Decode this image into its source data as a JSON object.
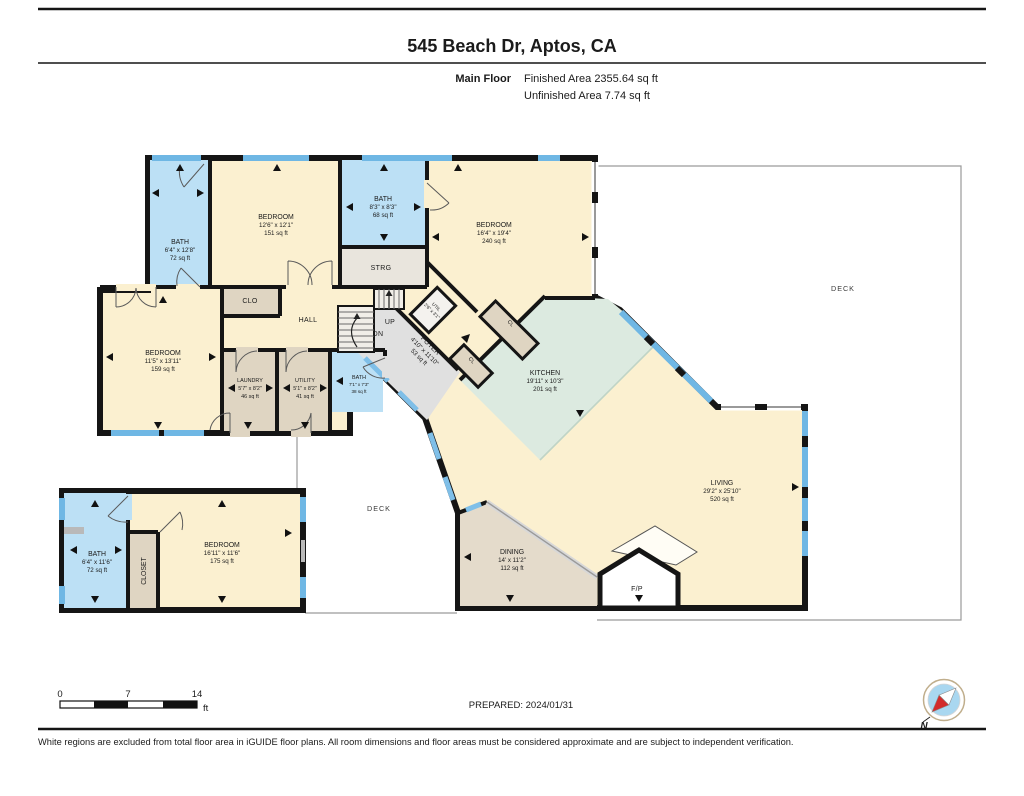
{
  "page": {
    "title": "545 Beach Dr, Aptos, CA",
    "floor_label": "Main Floor",
    "finished": "Finished Area 2355.64 sq ft",
    "unfinished": "Unfinished Area 7.74 sq ft",
    "prepared": "PREPARED: 2024/01/31",
    "disclaimer": "White regions are excluded from total floor area in iGUIDE floor plans. All room dimensions and floor areas must be considered approximate and are subject to independent verification."
  },
  "scale": {
    "t0": "0",
    "t1": "7",
    "t2": "14",
    "unit": "ft"
  },
  "compass": {
    "north": "N"
  },
  "colors": {
    "room_cream": "#FBF0D0",
    "room_blue": "#BCE0F5",
    "room_tan": "#DFD5C2",
    "room_gray": "#E0E0E0",
    "kitchen_teal": "#DCEAE0",
    "dining_tan": "#E4DBCB",
    "window_blue": "#6FB7E4",
    "wall_black": "#151515"
  },
  "rooms": {
    "bath_tl": {
      "name": "BATH",
      "dims": "6'4\" x 12'8\"",
      "area": "72 sq ft"
    },
    "bedroom_tl": {
      "name": "BEDROOM",
      "dims": "12'6\" x 12'1\"",
      "area": "151 sq ft"
    },
    "bath_top": {
      "name": "BATH",
      "dims": "8'3\" x 8'3\"",
      "area": "68 sq ft"
    },
    "strg": {
      "name": "STRG"
    },
    "clo": {
      "name": "CLO"
    },
    "hall": {
      "name": "HALL"
    },
    "bedroom_top": {
      "name": "BEDROOM",
      "dims": "16'4\" x 19'4\"",
      "area": "240 sq ft"
    },
    "bedroom_left": {
      "name": "BEDROOM",
      "dims": "11'5\" x 13'11\"",
      "area": "159 sq ft"
    },
    "laundry": {
      "name": "LAUNDRY",
      "dims": "5'7\" x 8'2\"",
      "area": "46 sq ft"
    },
    "utility": {
      "name": "UTILITY",
      "dims": "5'1\" x 8'2\"",
      "area": "41 sq ft"
    },
    "bath_mid": {
      "name": "BATH",
      "dims": "7'1\" x 7'3\"",
      "area": "38 sq ft"
    },
    "util_small": {
      "name": "UTIL",
      "dims": "2'6\" x 3'1\""
    },
    "foyer": {
      "name": "FOYER",
      "dims": "4'10\" x 11'10\"",
      "area": "53 sq ft"
    },
    "cl1": {
      "name": "CL"
    },
    "cl2": {
      "name": "CL"
    },
    "kitchen": {
      "name": "KITCHEN",
      "dims": "19'11\" x 10'3\"",
      "area": "201 sq ft"
    },
    "living": {
      "name": "LIVING",
      "dims": "29'2\" x 25'10\"",
      "area": "520 sq ft"
    },
    "dining": {
      "name": "DINING",
      "dims": "14' x 11'2\"",
      "area": "112 sq ft"
    },
    "fireplace": {
      "name": "F/P"
    },
    "deck_right": {
      "name": "DECK"
    },
    "deck_mid": {
      "name": "DECK"
    },
    "bath_ll": {
      "name": "BATH",
      "dims": "6'4\" x 11'6\"",
      "area": "72 sq ft"
    },
    "closet_ll": {
      "name": "CLOSET"
    },
    "bedroom_ll": {
      "name": "BEDROOM",
      "dims": "16'11\" x 11'6\"",
      "area": "175 sq ft"
    },
    "up": "UP",
    "dn": "DN"
  }
}
